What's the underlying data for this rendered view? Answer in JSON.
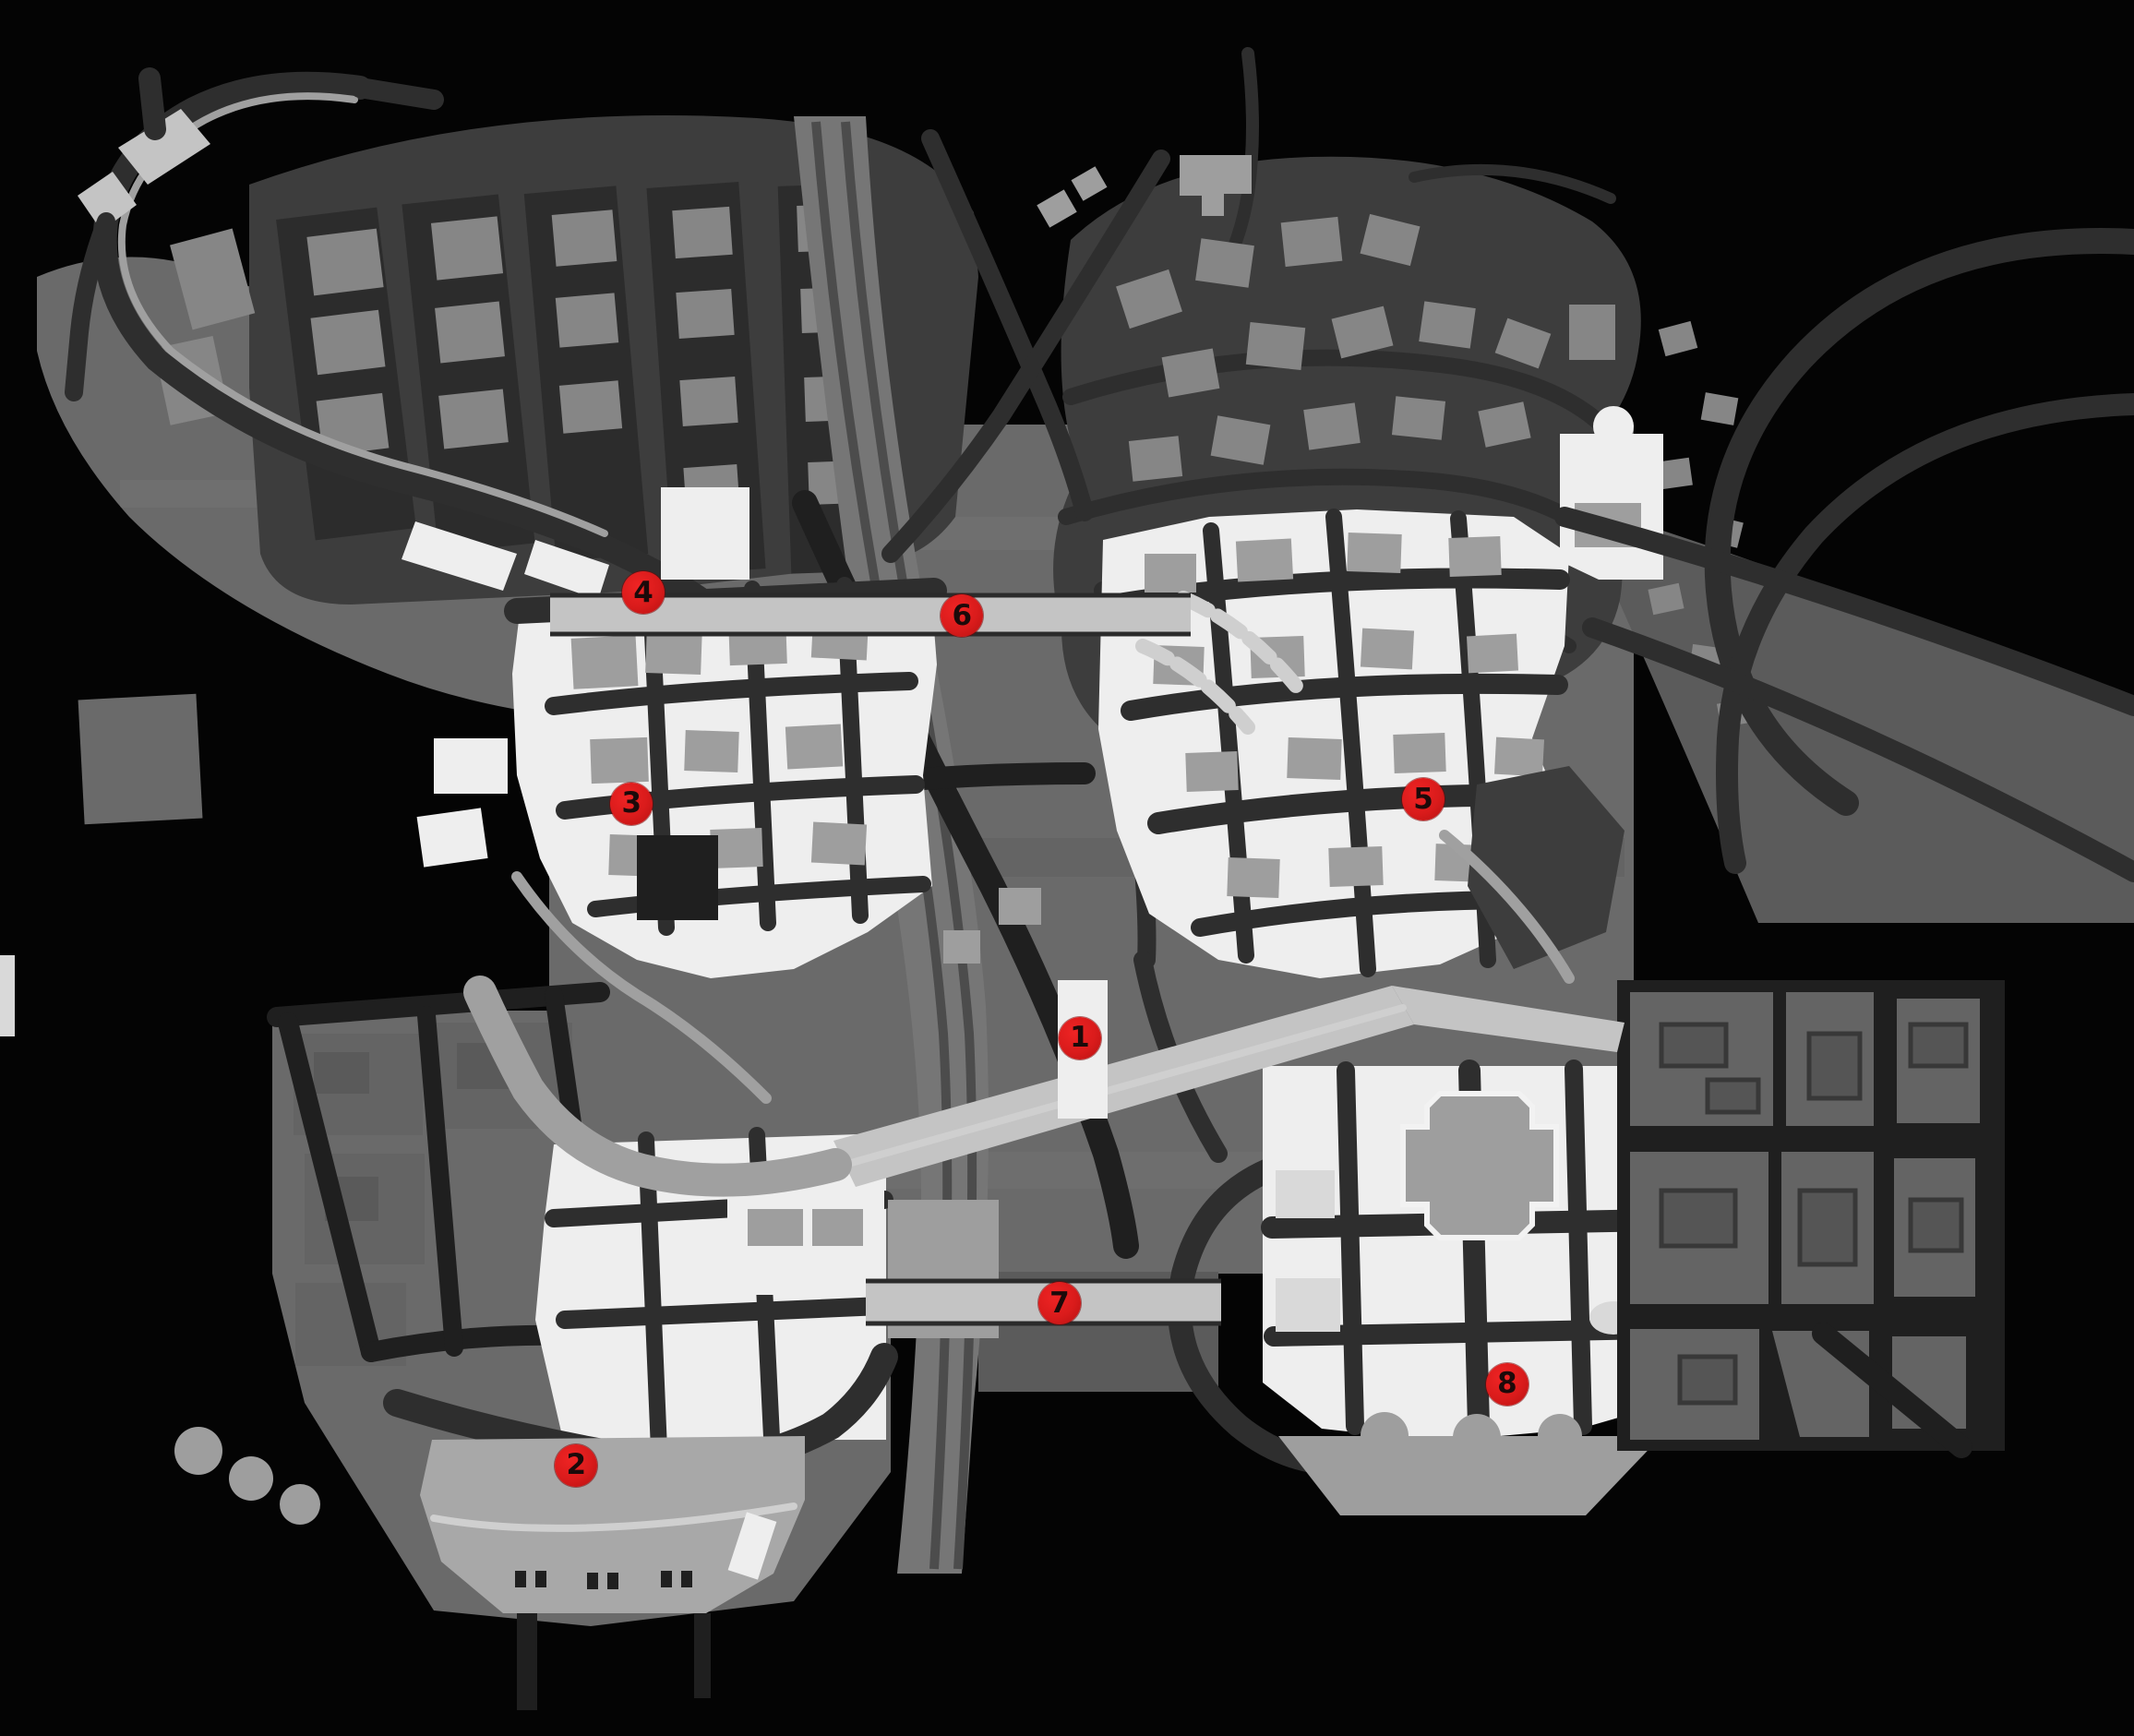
{
  "map": {
    "kind": "grayscale video game city map with numbered collectible location markers",
    "visible_text_note": "only visible text on screen is the red marker numerals"
  },
  "markers": [
    {
      "label": "1",
      "x_pct": 50.6,
      "y_pct": 59.8
    },
    {
      "label": "2",
      "x_pct": 27.0,
      "y_pct": 84.4
    },
    {
      "label": "3",
      "x_pct": 29.6,
      "y_pct": 46.3
    },
    {
      "label": "4",
      "x_pct": 30.15,
      "y_pct": 34.15
    },
    {
      "label": "5",
      "x_pct": 66.7,
      "y_pct": 46.05
    },
    {
      "label": "6",
      "x_pct": 45.08,
      "y_pct": 35.46
    },
    {
      "label": "7",
      "x_pct": 49.65,
      "y_pct": 75.07
    },
    {
      "label": "8",
      "x_pct": 70.63,
      "y_pct": 79.74
    }
  ],
  "colors": {
    "background": "#040404",
    "terrain_mid": "#6a6a6a",
    "terrain_dark": "#3d3d3d",
    "terrain_dim": "#5b5b5b",
    "road_dark": "#1f1f1f",
    "road_mid": "#2e2e2e",
    "building_gray": "#868686",
    "building_white": "#eeeeee",
    "bridge_light": "#c4c4c4",
    "rail_track": "#4c4c4c",
    "rail_band": "#767676",
    "wharf": "#a8a8a8",
    "marker_red": "#d91b1b",
    "marker_text": "#1c0a0a"
  }
}
